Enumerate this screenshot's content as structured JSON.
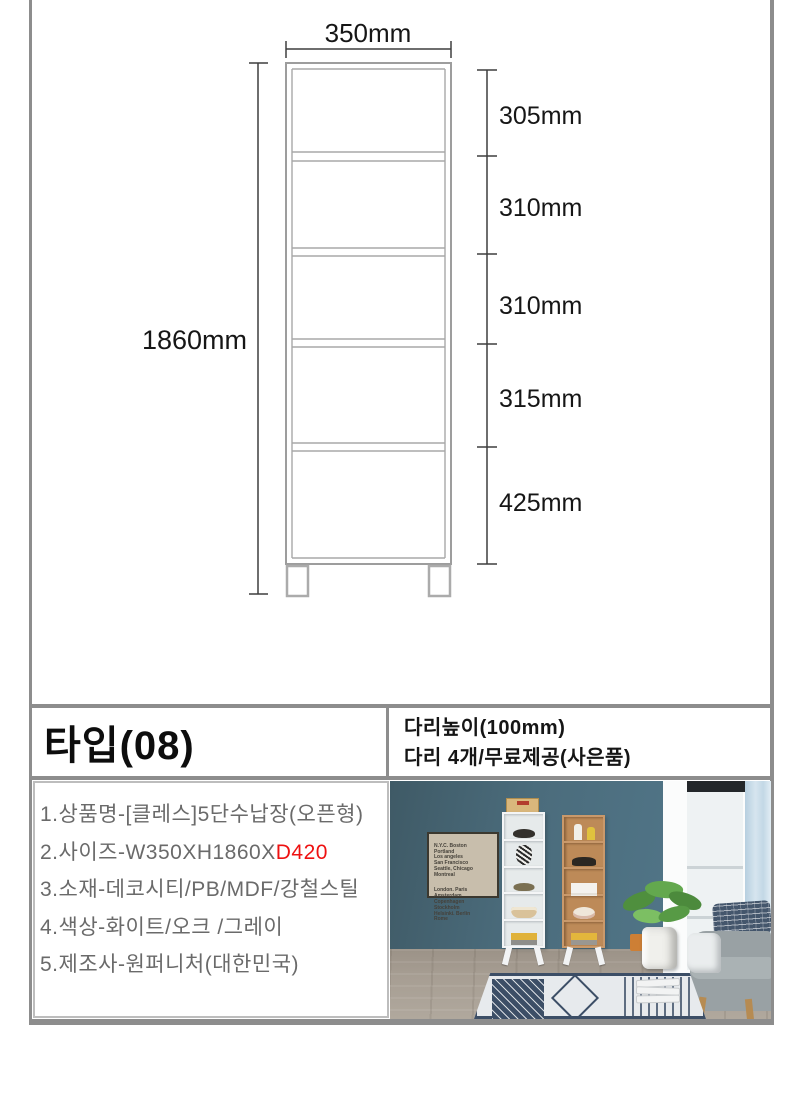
{
  "diagram": {
    "width_label": "350mm",
    "total_height_label": "1860mm",
    "sections": [
      "305mm",
      "310mm",
      "310mm",
      "315mm",
      "425mm"
    ]
  },
  "spec_bar": {
    "type_label": "타입(08)",
    "leg_height_label": "다리높이(100mm)",
    "leg_count_label": "다리 4개/무료제공(사은품)"
  },
  "product_info": {
    "line1": "1.상품명-[클레스]5단수납장(오픈형)",
    "line2_prefix": "2.사이즈-W350XH1860X",
    "line2_highlight": "D420",
    "line3": "3.소재-데코시티/PB/MDF/강철스틸",
    "line4": "4.색상-화이트/오크 /그레이",
    "line5": "5.제조사-원퍼니처(대한민국)",
    "highlight_color": "#ee1111"
  },
  "photo": {
    "poster_block1": "N.Y.C. Boston\nPortland\nLos angeles\nSan Francisco\nSeattle, Chicago\nMontreal",
    "poster_block2": "London. Paris\nAmsterdam\nCopenhagen\nStockholm\nHelsinki. Berlin\nRome"
  },
  "colors": {
    "page_border": "#8d8d8d",
    "info_text": "#6a6a6a",
    "wall_teal": "#4b6c7c",
    "oak_wood": "#c9996b"
  }
}
